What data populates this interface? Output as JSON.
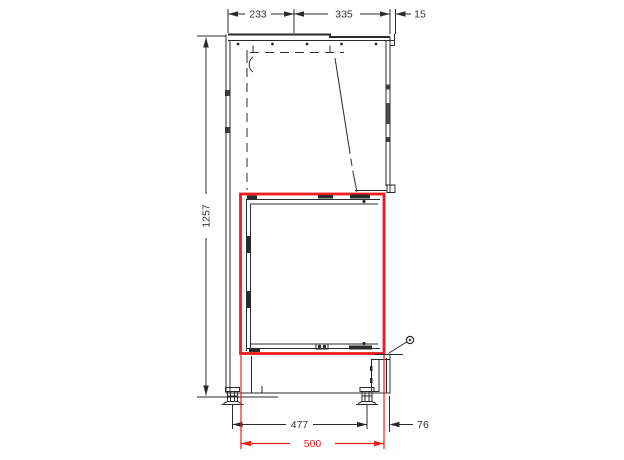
{
  "drawing": {
    "description": "fireplace-insert-side-section-technical-drawing",
    "line_color": "#2b2b2b",
    "highlight_color": "#ee1c1c",
    "background": "#ffffff",
    "dims": {
      "top_left_width": "233",
      "top_right_width": "335",
      "top_edge_offset": "15",
      "overall_height": "1257",
      "feet_spacing": "477",
      "right_overhang": "76",
      "opening_width": "500"
    }
  }
}
